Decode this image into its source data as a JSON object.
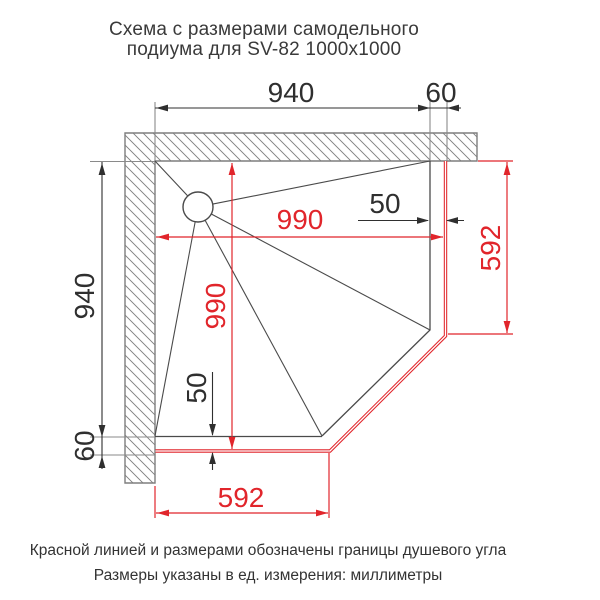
{
  "title": {
    "line1": "Схема с размерами самодельного",
    "line2": "подиума для SV-82 1000x1000"
  },
  "dims": {
    "podium_top_width": "940",
    "podium_top_offset": "60",
    "podium_left_height": "940",
    "podium_left_offset": "60",
    "shower_width": "990",
    "shower_height": "990",
    "gap_right": "50",
    "gap_bottom": "50",
    "shower_edge_right": "592",
    "shower_edge_bottom": "592"
  },
  "notes": {
    "line1": "Красной линией и размерами обозначены границы душевого угла",
    "line2": "Размеры указаны в ед. измерения: миллиметры"
  },
  "colors": {
    "shower_boundary_red": "#e1252b",
    "drawing_black": "#3e3e3e",
    "wall_gray": "#7e7e7e"
  },
  "units": "мм"
}
